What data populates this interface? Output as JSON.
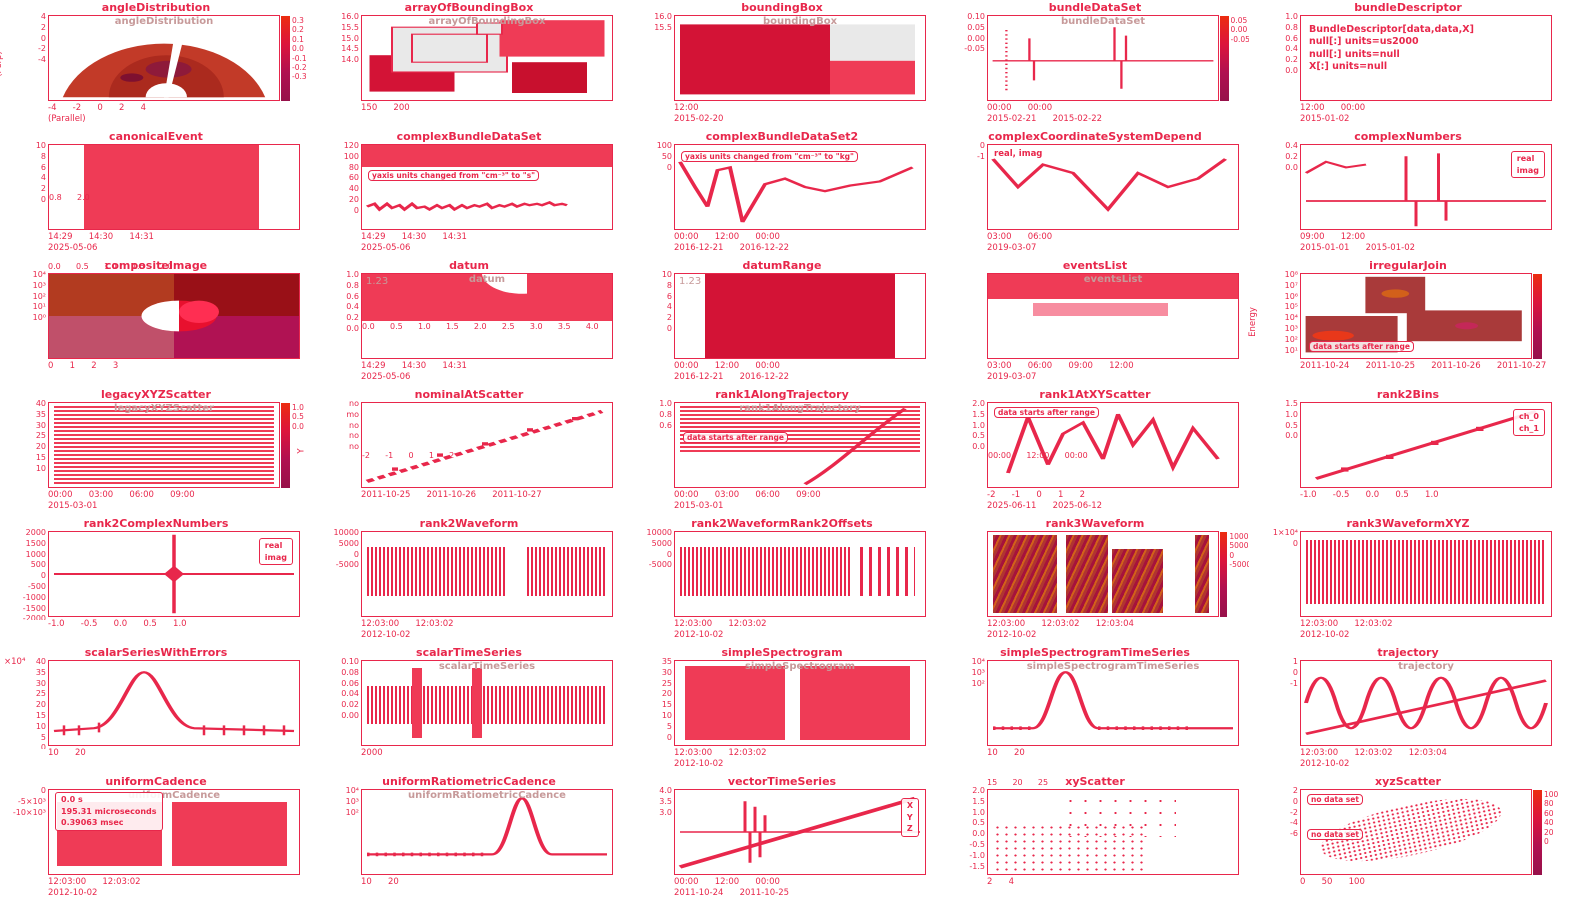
{
  "page": {
    "background": "#ffffff",
    "accent": "#dc143c",
    "ghost_title_color": "#c79a9a"
  },
  "chart_data": [
    {
      "name": "angleDistribution",
      "type": "heatmap",
      "title": "angleDistribution",
      "inner_title": "angleDistribution",
      "ylabel": "(Perp)",
      "xlabel": "(Parallel)",
      "xticks": [
        "-4",
        "-2",
        "0",
        "2",
        "4"
      ],
      "yticks": [
        "4",
        "2",
        "0",
        "-2",
        "-4"
      ],
      "cbar_ticks": [
        "0.3",
        "0.2",
        "0.1",
        "0.0",
        "-0.1",
        "-0.2",
        "-0.3"
      ]
    },
    {
      "name": "arrayOfBoundingBox",
      "type": "boxes",
      "title": "arrayOfBoundingBox",
      "inner_title": "arrayOfBoundingBox",
      "xticks": [
        "150",
        "200"
      ],
      "yticks": [
        "16.0",
        "15.5",
        "15.0",
        "14.5",
        "14.0"
      ]
    },
    {
      "name": "boundingBox",
      "type": "boxes",
      "title": "boundingBox",
      "inner_title": "boundingBox",
      "xticks": [
        "12:00"
      ],
      "dates": [
        "2015-02-20"
      ],
      "yticks": [
        "16.0",
        "15.5"
      ]
    },
    {
      "name": "bundleDataSet",
      "type": "line",
      "title": "bundleDataSet",
      "inner_title": "bundleDataSet",
      "yticks": [
        "0.10",
        "0.05",
        "0.00",
        "-0.05"
      ],
      "xticks": [
        "00:00",
        "00:00"
      ],
      "dates": [
        "2015-02-21",
        "2015-02-22"
      ],
      "cbar_ticks": [
        "0.05",
        "0.00",
        "-0.05"
      ]
    },
    {
      "name": "bundleDescriptor",
      "type": "text",
      "title": "bundleDescriptor",
      "text_lines": [
        "BundleDescriptor[data,data,X]",
        "null[:] units=us2000",
        "null[:] units=null",
        "X[:] units=null"
      ],
      "yticks": [
        "1.0",
        "0.8",
        "0.6",
        "0.4",
        "0.2",
        "0.0"
      ],
      "xticks": [
        "12:00",
        "00:00"
      ],
      "dates": [
        "2015-01-02"
      ]
    },
    {
      "name": "canonicalEvent",
      "type": "event-band",
      "title": "canonicalEvent",
      "yticks": [
        "10",
        "8",
        "6",
        "4",
        "2",
        "0"
      ],
      "xticks": [
        "14:29",
        "14:30",
        "14:31"
      ],
      "dates": [
        "2025-05-06"
      ],
      "xticks_alt": [
        "0.8",
        "2.0"
      ]
    },
    {
      "name": "complexBundleDataSet",
      "type": "line",
      "title": "complexBundleDataSet",
      "annotation": "yaxis units changed from \"cm⁻³\" to \"s\"",
      "yticks": [
        "120",
        "100",
        "80",
        "60",
        "40",
        "20",
        "0"
      ],
      "xticks": [
        "14:29",
        "14:30",
        "14:31"
      ],
      "dates": [
        "2025-05-06"
      ]
    },
    {
      "name": "complexBundleDataSet2",
      "type": "line",
      "title": "complexBundleDataSet2",
      "annotation": "yaxis units changed from \"cm⁻³\" to \"kg\"",
      "yticks": [
        "100",
        "50",
        "0"
      ],
      "xticks": [
        "00:00",
        "12:00",
        "00:00"
      ],
      "dates": [
        "2016-12-21",
        "2016-12-22"
      ]
    },
    {
      "name": "complexCoordinateSystemDepend",
      "type": "line",
      "title": "complexCoordinateSystemDepend",
      "series_label": "real, imag",
      "yticks": [
        "0",
        "-1"
      ],
      "xticks": [
        "03:00",
        "06:00"
      ],
      "dates": [
        "2019-03-07"
      ]
    },
    {
      "name": "complexNumbers",
      "type": "line",
      "title": "complexNumbers",
      "legend": [
        "real",
        "imag"
      ],
      "yticks": [
        "0.4",
        "0.2",
        "0.0"
      ],
      "xticks": [
        "09:00",
        "12:00"
      ],
      "dates": [
        "2015-01-01",
        "2015-01-02"
      ]
    },
    {
      "name": "compositeImage",
      "type": "image",
      "title": "compositeImage",
      "xticks": [
        "0",
        "1",
        "2",
        "3"
      ],
      "xticks_top": [
        "0.0",
        "0.5",
        "1.0",
        "1.5",
        "2.0"
      ],
      "yticks": [
        "10⁴",
        "10³",
        "10²",
        "10¹",
        "10⁰"
      ]
    },
    {
      "name": "datum",
      "type": "event-band",
      "title": "datum",
      "inner_title": "datum",
      "value": "1.23",
      "yticks": [
        "1.0",
        "0.8",
        "0.6",
        "0.4",
        "0.2",
        "0.0"
      ],
      "xticks": [
        "14:29",
        "14:30",
        "14:31"
      ],
      "dates": [
        "2025-05-06"
      ],
      "xticks_alt": [
        "0.0",
        "0.5",
        "1.0",
        "1.5",
        "2.0",
        "2.5",
        "3.0",
        "3.5",
        "4.0"
      ]
    },
    {
      "name": "datumRange",
      "type": "range-band",
      "title": "datumRange",
      "value": "1.23",
      "yticks": [
        "10",
        "8",
        "6",
        "4",
        "2",
        "0"
      ],
      "xticks": [
        "00:00",
        "12:00",
        "00:00"
      ],
      "dates": [
        "2016-12-21",
        "2016-12-22"
      ]
    },
    {
      "name": "eventsList",
      "type": "events",
      "title": "eventsList",
      "inner_title": "eventsList",
      "xticks": [
        "03:00",
        "06:00",
        "09:00",
        "12:00"
      ],
      "dates": [
        "2019-03-07"
      ]
    },
    {
      "name": "irregularJoin",
      "type": "heatmap",
      "title": "irregularJoin",
      "ylabel": "Energy",
      "annotation": "data starts after range",
      "yticks": [
        "10⁸",
        "10⁷",
        "10⁶",
        "10⁵",
        "10⁴",
        "10³",
        "10²",
        "10¹"
      ],
      "xticks": [
        "2011-10-24",
        "2011-10-25",
        "2011-10-26",
        "2011-10-27"
      ]
    },
    {
      "name": "legacyXYZScatter",
      "type": "spectrogram",
      "title": "legacyXYZScatter",
      "inner_title": "legacyXYZScatter",
      "yticks": [
        "40",
        "35",
        "30",
        "25",
        "20",
        "15",
        "10"
      ],
      "xticks": [
        "00:00",
        "03:00",
        "06:00",
        "09:00"
      ],
      "dates": [
        "2015-03-01"
      ],
      "cbar_ticks": [
        "1.0",
        "0.5",
        "0.0"
      ]
    },
    {
      "name": "nominalAtScatter",
      "type": "nominal-scatter",
      "title": "nominalAtScatter",
      "ylabel": "Y",
      "labels": [
        "no",
        "mo",
        "no",
        "no",
        "no"
      ],
      "xticks": [
        "2011-10-25",
        "2011-10-26",
        "2011-10-27"
      ],
      "xticks_alt": [
        "-2",
        "-1",
        "0",
        "1",
        "2"
      ]
    },
    {
      "name": "rank1AlongTrajectory",
      "type": "spectrogram",
      "title": "rank1AlongTrajectory",
      "inner_title": "rank1AlongTrajectory",
      "annotation": "data starts after range",
      "yticks": [
        "1.0",
        "0.8",
        "0.6"
      ],
      "xticks": [
        "00:00",
        "03:00",
        "06:00",
        "09:00"
      ],
      "dates": [
        "2015-03-01"
      ]
    },
    {
      "name": "rank1AtXYScatter",
      "type": "scatter-line",
      "title": "rank1AtXYScatter",
      "annotation": "data starts after range",
      "yticks": [
        "2.0",
        "1.5",
        "1.0",
        "0.5",
        "0.0"
      ],
      "xticks": [
        "-2",
        "-1",
        "0",
        "1",
        "2"
      ],
      "xticks_alt": [
        "00:00",
        "12:00",
        "00:00"
      ],
      "dates": [
        "2025-06-11",
        "2025-06-12"
      ]
    },
    {
      "name": "rank2Bins",
      "type": "line-markers",
      "title": "rank2Bins",
      "legend": [
        "ch_0",
        "ch_1"
      ],
      "yticks": [
        "1.5",
        "1.0",
        "0.5",
        "0.0"
      ],
      "xticks": [
        "-1.0",
        "-0.5",
        "0.0",
        "0.5",
        "1.0"
      ]
    },
    {
      "name": "rank2ComplexNumbers",
      "type": "line",
      "title": "rank2ComplexNumbers",
      "legend": [
        "real",
        "imag"
      ],
      "yticks": [
        "2000",
        "1500",
        "1000",
        "500",
        "0",
        "-500",
        "-1000",
        "-1500",
        "-2000"
      ],
      "xticks": [
        "-1.0",
        "-0.5",
        "0.0",
        "0.5",
        "1.0"
      ]
    },
    {
      "name": "rank2Waveform",
      "type": "waveform",
      "title": "rank2Waveform",
      "yticks": [
        "10000",
        "5000",
        "0",
        "-5000"
      ],
      "xticks": [
        "12:03:00",
        "12:03:02"
      ],
      "dates": [
        "2012-10-02"
      ]
    },
    {
      "name": "rank2WaveformRank2Offsets",
      "type": "waveform",
      "title": "rank2WaveformRank2Offsets",
      "yticks": [
        "10000",
        "5000",
        "0",
        "-5000"
      ],
      "xticks": [
        "12:03:00",
        "12:03:02"
      ],
      "dates": [
        "2012-10-02"
      ]
    },
    {
      "name": "rank3Waveform",
      "type": "spectrogram",
      "title": "rank3Waveform",
      "xticks": [
        "12:03:00",
        "12:03:02",
        "12:03:04"
      ],
      "dates": [
        "2012-10-02"
      ],
      "cbar_ticks": [
        "10000",
        "5000",
        "0",
        "-5000"
      ]
    },
    {
      "name": "rank3WaveformXYZ",
      "type": "waveform",
      "title": "rank3WaveformXYZ",
      "yticks": [
        "1×10⁴",
        "0"
      ],
      "xticks": [
        "12:03:00",
        "12:03:02"
      ],
      "dates": [
        "2012-10-02"
      ]
    },
    {
      "name": "scalarSeriesWithErrors",
      "type": "line-errorbars",
      "title": "scalarSeriesWithErrors",
      "multiplier": "×10⁴",
      "yticks": [
        "40",
        "35",
        "30",
        "25",
        "20",
        "15",
        "10",
        "5",
        "0"
      ],
      "xticks": [
        "10",
        "20"
      ]
    },
    {
      "name": "scalarTimeSeries",
      "type": "waveform",
      "title": "scalarTimeSeries",
      "inner_title": "scalarTimeSeries",
      "yticks": [
        "0.10",
        "0.08",
        "0.06",
        "0.04",
        "0.02",
        "0.00"
      ],
      "xticks": [
        "2000"
      ]
    },
    {
      "name": "simpleSpectrogram",
      "type": "spectrogram",
      "title": "simpleSpectrogram",
      "inner_title": "simpleSpectrogram",
      "yticks": [
        "35",
        "30",
        "25",
        "20",
        "15",
        "10",
        "5",
        "0"
      ],
      "xticks": [
        "12:03:00",
        "12:03:02"
      ],
      "dates": [
        "2012-10-02"
      ]
    },
    {
      "name": "simpleSpectrogramTimeSeries",
      "type": "line",
      "title": "simpleSpectrogramTimeSeries",
      "inner_title": "simpleSpectrogramTimeSeries",
      "yticks": [
        "10⁴",
        "10³",
        "10²"
      ],
      "xticks": [
        "10",
        "20"
      ]
    },
    {
      "name": "trajectory",
      "type": "line",
      "title": "trajectory",
      "inner_title": "trajectory",
      "yticks": [
        "1",
        "0",
        "-1"
      ],
      "xticks": [
        "12:03:00",
        "12:03:02",
        "12:03:04"
      ],
      "dates": [
        "2012-10-02"
      ]
    },
    {
      "name": "uniformCadence",
      "type": "events",
      "title": "uniformCadence",
      "inner_title": "uniformCadence",
      "legend": [
        "0.0 s",
        "195.31 microseconds",
        "0.39063 msec"
      ],
      "yticks": [
        "0",
        "-5×10³",
        "-10×10³"
      ],
      "xticks": [
        "12:03:00",
        "12:03:02"
      ],
      "dates": [
        "2012-10-02"
      ]
    },
    {
      "name": "uniformRatiometricCadence",
      "type": "line",
      "title": "uniformRatiometricCadence",
      "inner_title": "uniformRatiometricCadence",
      "yticks": [
        "10⁴",
        "10³",
        "10²"
      ],
      "xticks": [
        "10",
        "20"
      ]
    },
    {
      "name": "vectorTimeSeries",
      "type": "line",
      "title": "vectorTimeSeries",
      "legend": [
        "X",
        "Y",
        "Z"
      ],
      "yticks": [
        "4.0",
        "3.5",
        "3.0"
      ],
      "xticks": [
        "00:00",
        "12:00",
        "00:00"
      ],
      "dates": [
        "2011-10-24",
        "2011-10-25"
      ]
    },
    {
      "name": "xyScatter",
      "type": "scatter",
      "title": "xyScatter",
      "yticks": [
        "2.0",
        "1.5",
        "1.0",
        "0.5",
        "0.0",
        "-0.5",
        "-1.0",
        "-1.5"
      ],
      "xticks": [
        "2",
        "4"
      ],
      "xticks_top": [
        "15",
        "20",
        "25"
      ]
    },
    {
      "name": "xyzScatter",
      "type": "scatter",
      "title": "xyzScatter",
      "annotation": "no data set",
      "annotation2": "no data set",
      "yticks": [
        "2",
        "0",
        "-2",
        "-4",
        "-6"
      ],
      "xticks": [
        "0",
        "50",
        "100"
      ],
      "cbar_ticks": [
        "100",
        "80",
        "60",
        "40",
        "20",
        "0"
      ]
    }
  ]
}
